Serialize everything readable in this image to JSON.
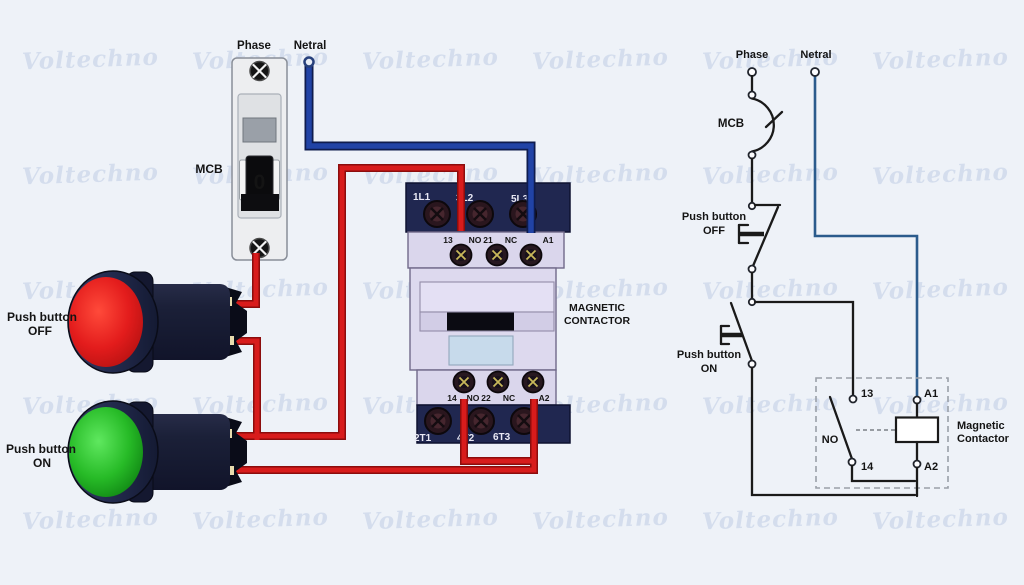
{
  "watermark": {
    "text": "Voltechno"
  },
  "colors": {
    "phase_wire": "#d81c1c",
    "neutral_wire": "#2143a6",
    "schematic_neutral": "#2b5b8c"
  },
  "left": {
    "phase_label": "Phase",
    "netral_label": "Netral",
    "mcb_label": "MCB",
    "mcb_toggle": "0",
    "off_button": {
      "line1": "Push button",
      "line2": "OFF"
    },
    "on_button": {
      "line1": "Push button",
      "line2": "ON"
    },
    "contactor": {
      "label_line1": "MAGNETIC",
      "label_line2": "CONTACTOR",
      "top_terminals": [
        "1L1",
        "3L2",
        "5L3"
      ],
      "aux_top": [
        "13",
        "NO",
        "21",
        "NC",
        "A1"
      ],
      "aux_bottom": [
        "14",
        "NO",
        "22",
        "NC",
        "A2"
      ],
      "bottom_terminals": [
        "2T1",
        "4T2",
        "6T3"
      ]
    }
  },
  "schematic": {
    "phase_label": "Phase",
    "netral_label": "Netral",
    "mcb_label": "MCB",
    "off_button": {
      "line1": "Push button",
      "line2": "OFF"
    },
    "on_button": {
      "line1": "Push button",
      "line2": "ON"
    },
    "contactor": {
      "t13": "13",
      "t14": "14",
      "a1": "A1",
      "a2": "A2",
      "no": "NO",
      "label_line1": "Magnetic",
      "label_line2": "Contactor"
    }
  }
}
